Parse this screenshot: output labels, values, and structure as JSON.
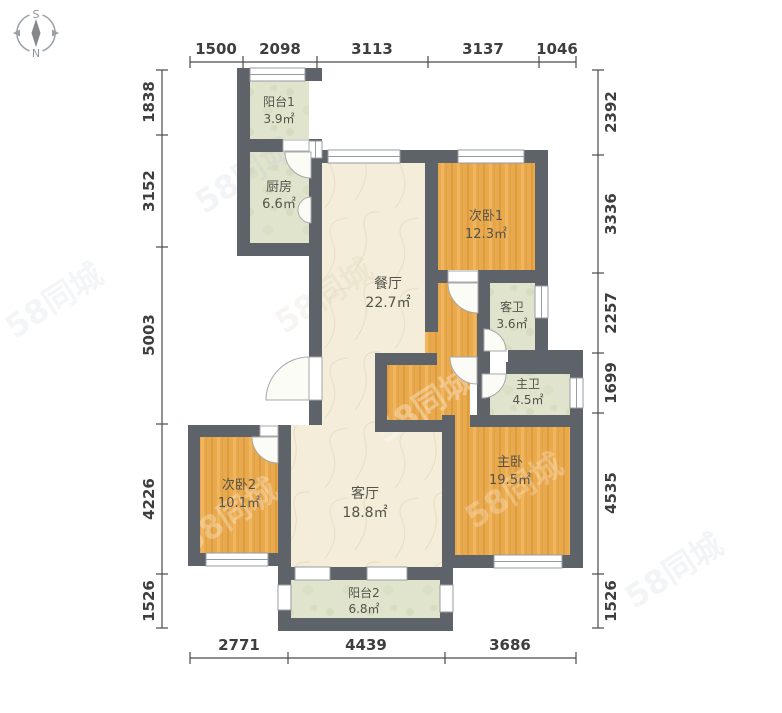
{
  "compass": {
    "top_label": "S",
    "bottom_label": "N"
  },
  "watermark_text": "58同城",
  "rooms": [
    {
      "name": "阳台1",
      "area": "3.9㎡"
    },
    {
      "name": "厨房",
      "area": "6.6㎡"
    },
    {
      "name": "餐厅",
      "area": "22.7㎡"
    },
    {
      "name": "次卧1",
      "area": "12.3㎡"
    },
    {
      "name": "客卫",
      "area": "3.6㎡"
    },
    {
      "name": "主卫",
      "area": "4.5㎡"
    },
    {
      "name": "主卧",
      "area": "19.5㎡"
    },
    {
      "name": "次卧2",
      "area": "10.1㎡"
    },
    {
      "name": "客厅",
      "area": "18.8㎡"
    },
    {
      "name": "阳台2",
      "area": "6.8㎡"
    }
  ],
  "dimensions": {
    "top": [
      "1500",
      "2098",
      "3113",
      "3137",
      "1046"
    ],
    "bottom": [
      "2771",
      "4439",
      "3686"
    ],
    "left": [
      "1838",
      "3152",
      "5003",
      "4226",
      "1526"
    ],
    "right": [
      "2392",
      "3336",
      "2257",
      "1699",
      "4535",
      "1526"
    ]
  },
  "colors": {
    "wall": "#5d6369",
    "wood_floor": "#e9a94d",
    "marble_floor": "#f3edd9",
    "tile_floor": "#e0e4cd",
    "dimension_text": "#3e3e3e",
    "label_text": "#54534b"
  }
}
